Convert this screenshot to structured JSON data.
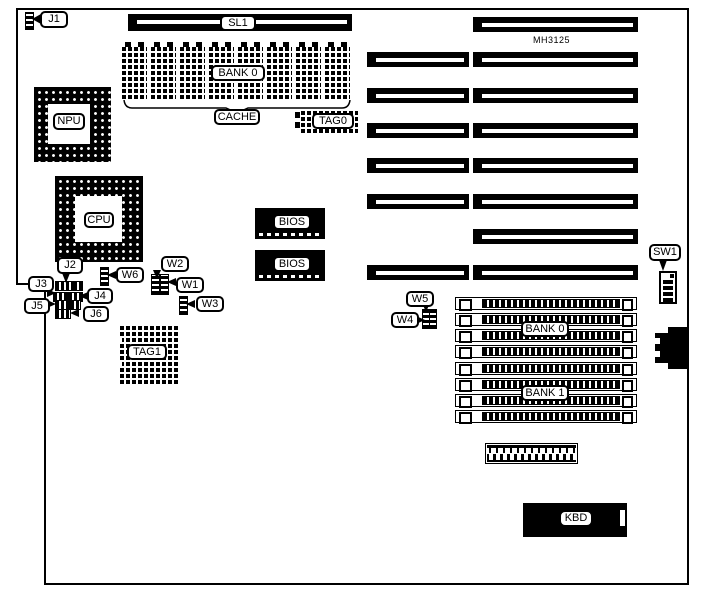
{
  "board": {
    "model": "MH3125"
  },
  "labels": {
    "j1": "J1",
    "sl1": "SL1",
    "cache_bank": "BANK 0",
    "cache": "CACHE",
    "tag0": "TAG0",
    "npu": "NPU",
    "cpu": "CPU",
    "j2": "J2",
    "j3": "J3",
    "j4": "J4",
    "j5": "J5",
    "j6": "J6",
    "w1": "W1",
    "w2": "W2",
    "w3": "W3",
    "w4": "W4",
    "w5": "W5",
    "w6": "W6",
    "bios_top": "BIOS",
    "bios_bottom": "BIOS",
    "tag1": "TAG1",
    "sw1": "SW1",
    "simm_bank0": "BANK 0",
    "simm_bank1": "BANK 1",
    "kbd": "KBD"
  }
}
